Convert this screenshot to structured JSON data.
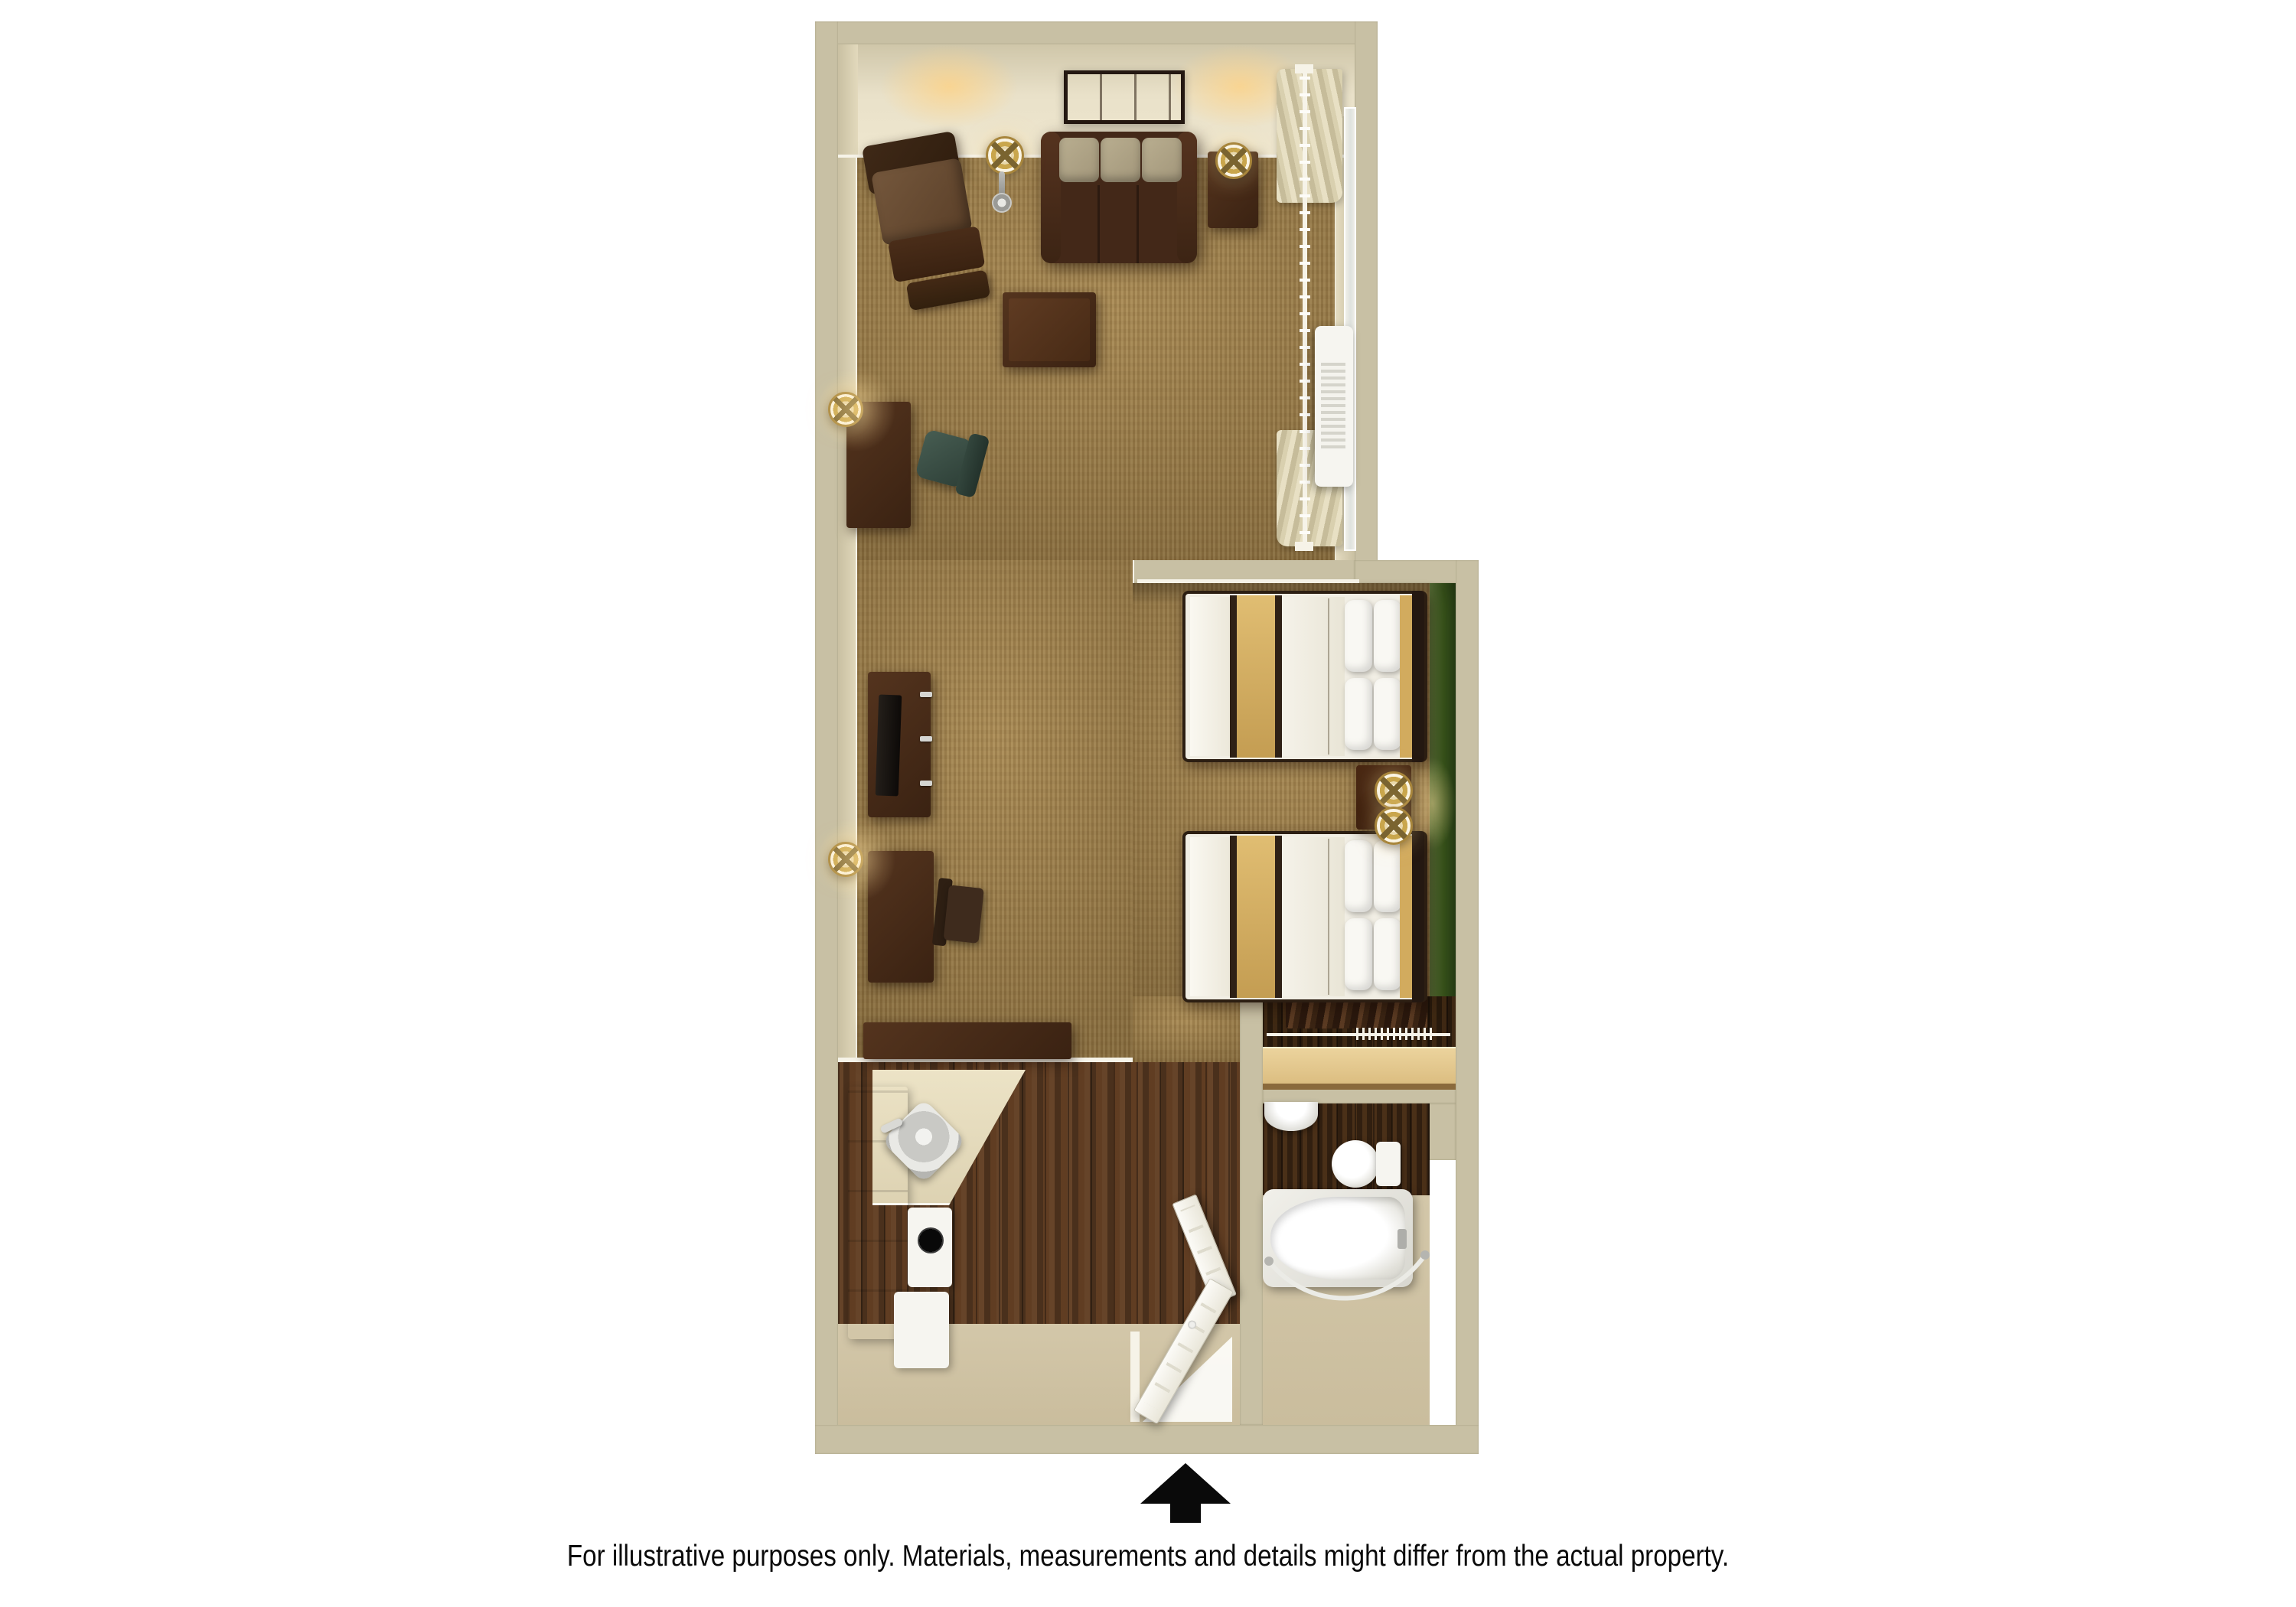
{
  "disclaimer": "For illustrative purposes only.  Materials, measurements and details might differ from the actual property.",
  "entry": {
    "arrow_icon": "up-arrow",
    "arrow_color": "#000000"
  },
  "palette": {
    "background": "#ffffff",
    "wall": "#c8c0a4",
    "wall_face_light": "#efe7cf",
    "baseboard_white": "#f6f3e8",
    "carpet": "#9c7c46",
    "hardwood_dark": "#573821",
    "closet_floor": "#32200f",
    "green_accent_wall": "#41601f",
    "espresso_furniture": "#44291a",
    "sofa_cushion_tan": "#ab9e7f",
    "bed_runner_tan": "#d2ab5e",
    "bedding_white": "#f1eee4",
    "fixture_white": "#f6f5f0",
    "counter_cream": "#e8dfc2",
    "cabinet_white": "#efede2",
    "lamp_gold": "#c9a64c",
    "stainless": "#c6c6c2",
    "office_chair_green": "#3e5248",
    "tv_black": "#17120e",
    "text": "#0a0a0a"
  },
  "rooms": [
    {
      "id": "living-area",
      "name": "living-area"
    },
    {
      "id": "sleeping-area",
      "name": "sleeping-area"
    },
    {
      "id": "closet",
      "name": "closet"
    },
    {
      "id": "bathroom",
      "name": "bathroom"
    },
    {
      "id": "kitchen",
      "name": "kitchen"
    },
    {
      "id": "entry",
      "name": "entry"
    }
  ],
  "fixtures": [
    "wall-art",
    "sofa",
    "floor-lamp",
    "side-table",
    "table-lamp",
    "armchair",
    "coffee-table",
    "window-curtains",
    "curtain-rod",
    "ac-unit",
    "desk",
    "office-chair",
    "desk-lamp",
    "tv-console",
    "television",
    "side-chair",
    "bed",
    "pillow",
    "nightstand",
    "nightstand-lamp",
    "closet-shelf",
    "closet-rod",
    "hanging-clothes",
    "bathroom-sink",
    "toilet",
    "bathtub",
    "shower-rod",
    "bathroom-door",
    "entry-door",
    "kitchen-counter",
    "kitchen-cabinets",
    "kitchen-sink",
    "faucet",
    "laundry-appliance"
  ]
}
